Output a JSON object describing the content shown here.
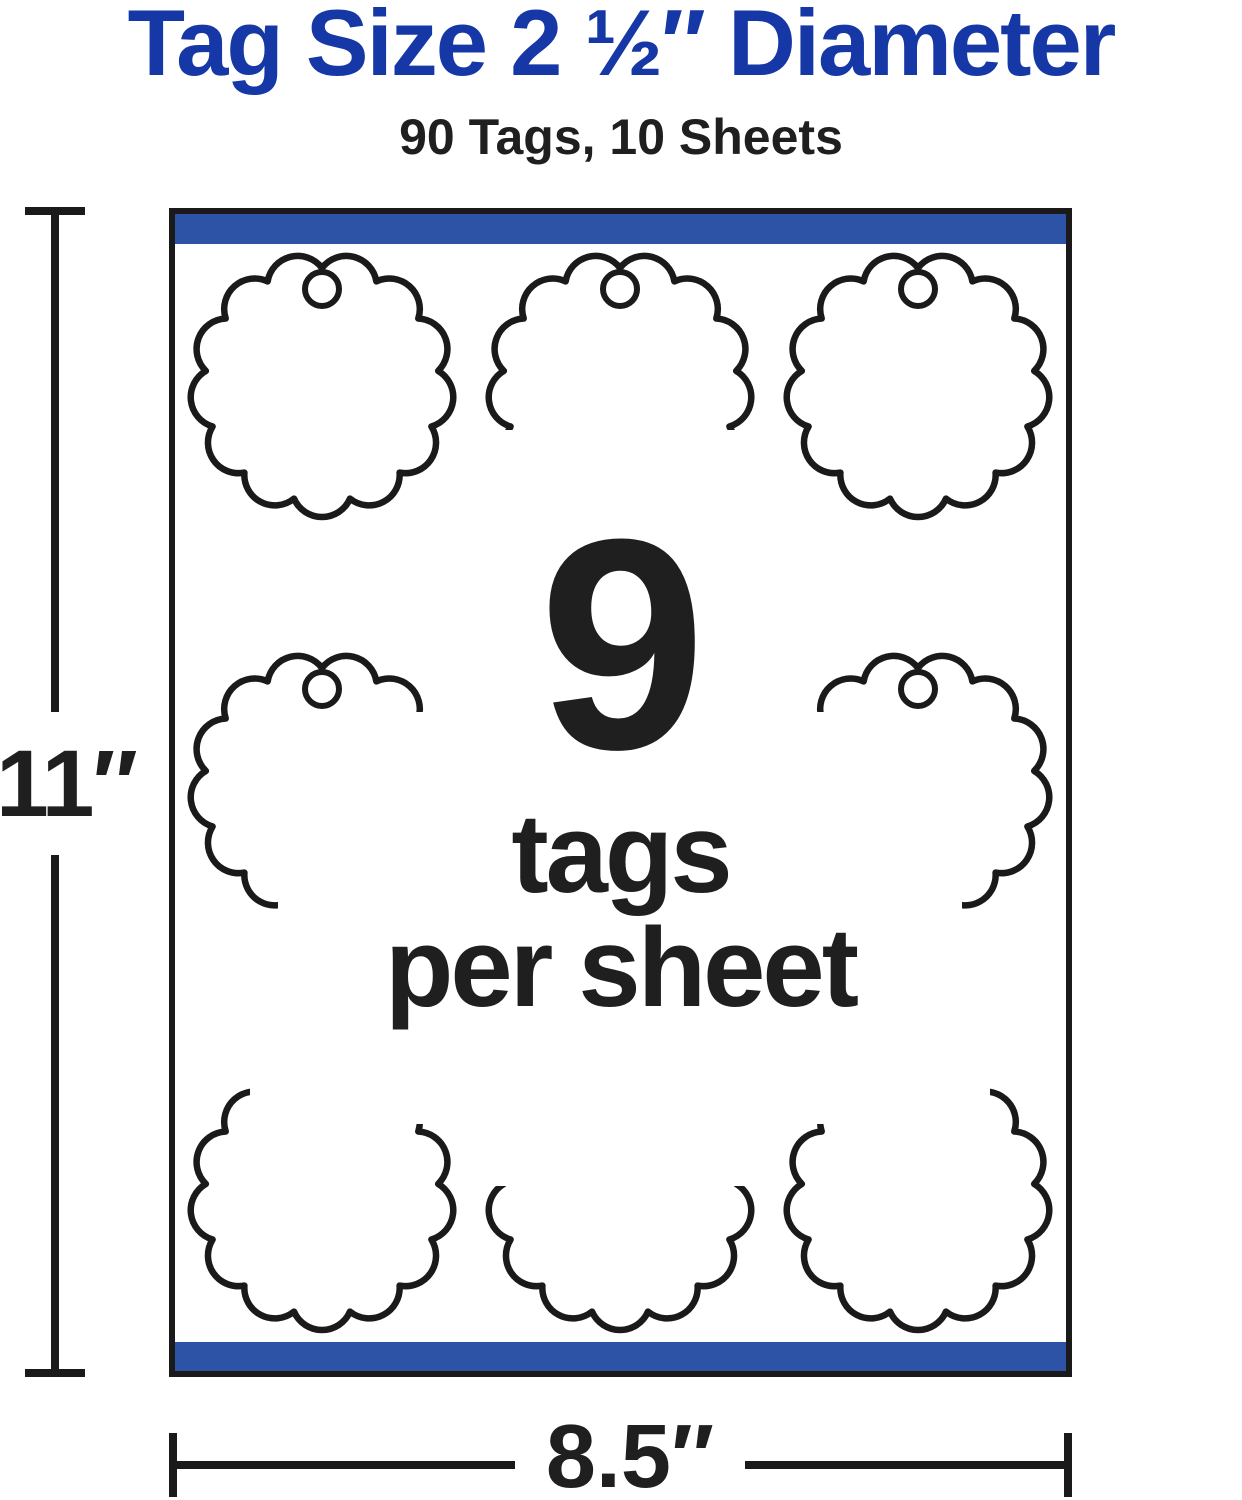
{
  "header": {
    "title": "Tag Size 2 ½″ Diameter",
    "subtitle": "90 Tags, 10 Sheets"
  },
  "sheet": {
    "per_sheet_count": "9",
    "per_sheet_word1": "tags",
    "per_sheet_word2": "per sheet",
    "tag_shape": "scalloped-circle-with-hanging-hole",
    "grid": "3x3"
  },
  "dimensions": {
    "height": "11″",
    "width": "8.5″"
  },
  "colors": {
    "title_blue": "#1638A6",
    "bar_blue": "#2D53A6",
    "outline_black": "#1A1A1A",
    "text_black": "#1F1F1F",
    "background": "#FFFFFF"
  }
}
